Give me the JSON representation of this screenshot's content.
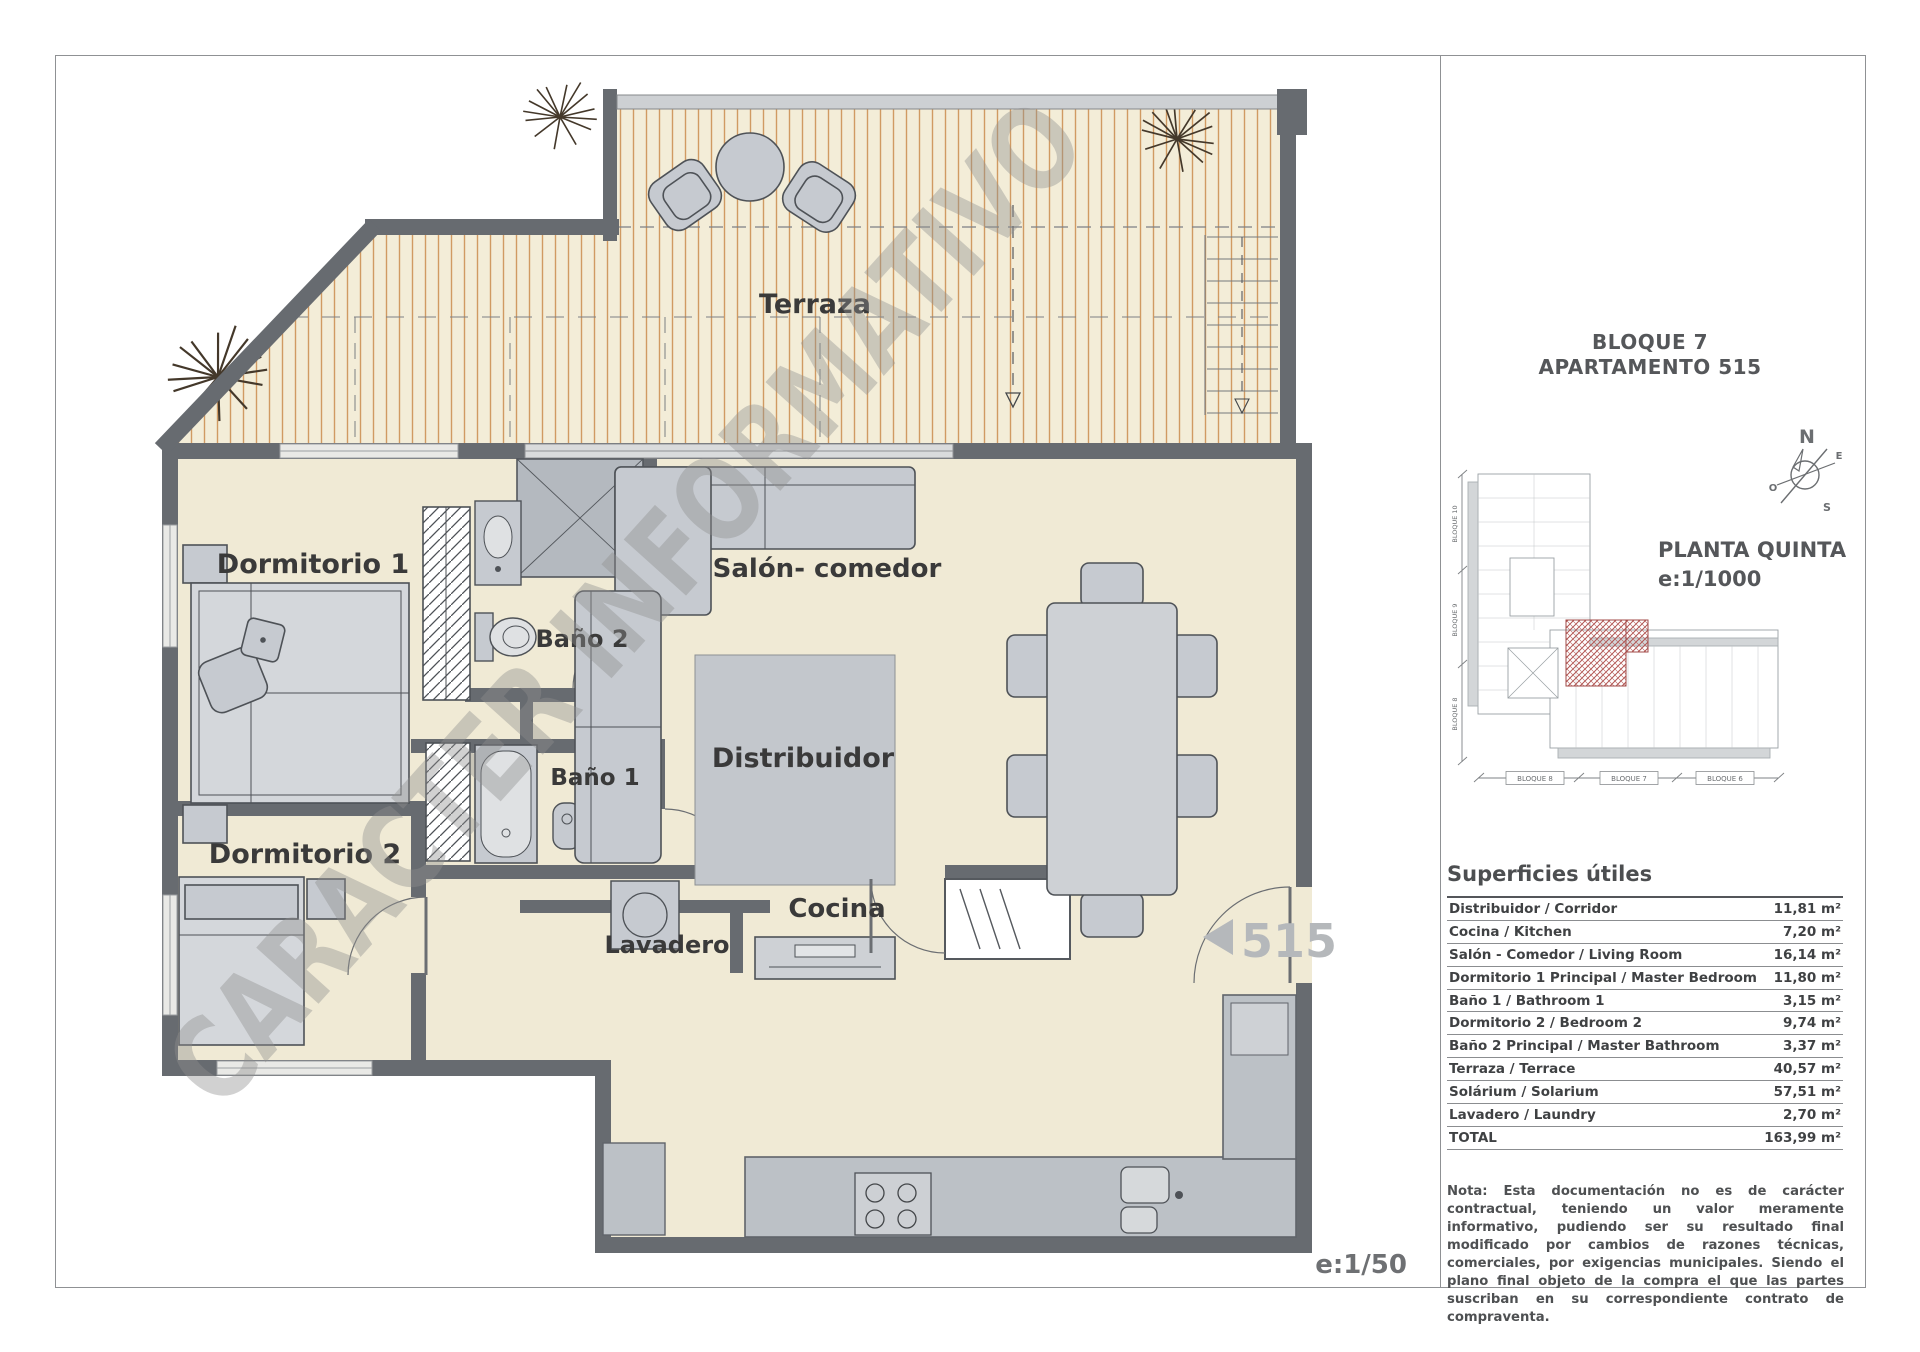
{
  "header": {
    "line1": "BLOQUE 7",
    "line2": "APARTAMENTO 515"
  },
  "site_plan": {
    "title": "PLANTA QUINTA",
    "scale": "e:1/1000",
    "bottom_blocks": [
      "BLOQUE 8",
      "BLOQUE 7",
      "BLOQUE 6"
    ],
    "left_blocks": [
      "BLOQUE 10",
      "BLOQUE 9",
      "BLOQUE 8"
    ],
    "compass": {
      "n": "N",
      "e": "E",
      "s": "S",
      "o": "O"
    },
    "highlight_color": "#b25552"
  },
  "floor_plan": {
    "watermark": "CARACTER INFORMATIVO",
    "unit_number": "515",
    "scale_label": "e:1/50",
    "labels": {
      "terraza": "Terraza",
      "dormitorio1": "Dormitorio 1",
      "bano2": "Baño 2",
      "salon": "Salón- comedor",
      "dormitorio2": "Dormitorio 2",
      "bano1": "Baño 1",
      "distribuidor": "Distribuidor",
      "cocina": "Cocina",
      "lavadero": "Lavadero"
    },
    "colors": {
      "wall": "#676b70",
      "floor": "#f0ead5",
      "deck_stripe": "#d09a62",
      "furniture": "#c6cad0",
      "label_text": "#3a3a3a",
      "unit_text": "#b5b8bb"
    }
  },
  "areas_table": {
    "title": "Superficies útiles",
    "rows": [
      {
        "label": "Distribuidor / Corridor",
        "value": "11,81 m²"
      },
      {
        "label": "Cocina / Kitchen",
        "value": "7,20 m²"
      },
      {
        "label": "Salón - Comedor / Living Room",
        "value": "16,14 m²"
      },
      {
        "label": "Dormitorio 1 Principal / Master Bedroom",
        "value": "11,80 m²"
      },
      {
        "label": "Baño 1 / Bathroom 1",
        "value": "3,15 m²"
      },
      {
        "label": "Dormitorio 2 / Bedroom 2",
        "value": "9,74 m²"
      },
      {
        "label": "Baño 2 Principal / Master Bathroom",
        "value": "3,37 m²"
      },
      {
        "label": "Terraza / Terrace",
        "value": "40,57 m²"
      },
      {
        "label": "Solárium  / Solarium",
        "value": "57,51 m²"
      },
      {
        "label": "Lavadero  / Laundry",
        "value": "2,70 m²"
      },
      {
        "label": "TOTAL",
        "value": "163,99 m²"
      }
    ]
  },
  "note": {
    "text": "Nota: Esta documentación no es de carácter contractual, teniendo un valor meramente informativo, pudiendo ser su resultado final modificado por cambios de razones técnicas, comerciales, por exigencias municipales. Siendo el plano final objeto de la compra el que las partes suscriban en su correspondiente contrato de compraventa."
  }
}
